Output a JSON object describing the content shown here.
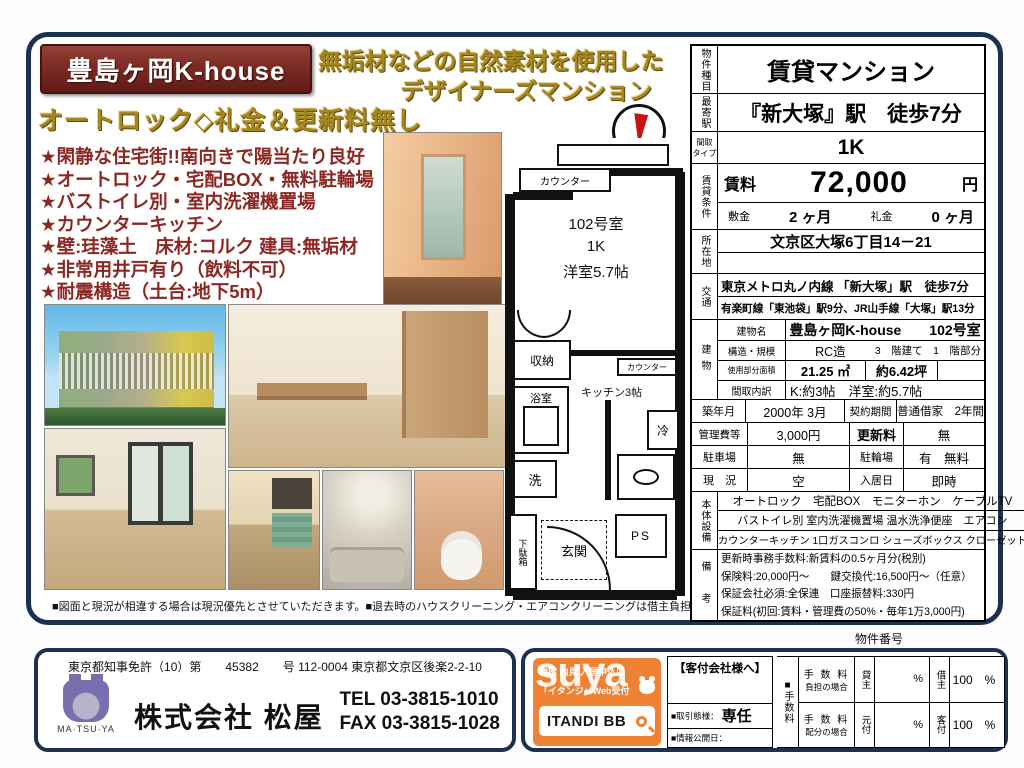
{
  "colors": {
    "maroon": "#7c2a24",
    "gold": "#a6871f",
    "navy": "#1c3150",
    "orange": "#ef8132",
    "feature_red": "#8c2723",
    "logo_purple": "#7a6fae"
  },
  "header": {
    "title": "豊島ヶ岡K-house",
    "subtitle1": "無垢材などの自然素材を使用した",
    "subtitle2": "デザイナーズマンション",
    "tagline": "オートロック◇礼金＆更新料無し"
  },
  "features": [
    "★閑静な住宅街!!南向きで陽当たり良好",
    "★オートロック・宅配BOX・無料駐輪場",
    "★バストイレ別・室内洗濯機置場",
    "★カウンターキッチン",
    "★壁:珪藻土　床材:コルク 建具:無垢材",
    "★非常用井戸有り（飲料不可）",
    "★耐震構造（土台:地下5m）"
  ],
  "plan": {
    "room_no": "102号室",
    "layout": "1K",
    "room_size": "洋室5.7帖",
    "kitchen": "キッチン3帖",
    "counter_top": "カウンター",
    "counter_mid": "カウンター",
    "closet": "収納",
    "bath": "浴室",
    "wash": "洗",
    "fridge": "冷",
    "entrance": "玄関",
    "shoebox": "下駄箱",
    "ps": "PS",
    "north": "N"
  },
  "disclaimer": "■図面と現況が相違する場合は現況優先とさせていただきます。■退去時のハウスクリーニング・エアコンクリーニングは借主負担です。",
  "spec": {
    "type_label": "物件種目",
    "type": "賃貸マンション",
    "station_label": "最寄駅",
    "station": "『新大塚』駅　徒歩7分",
    "madori_label1": "間取",
    "madori_label2": "タイプ",
    "madori": "1K",
    "terms_label": "賃貸条件",
    "rent_label": "賃料",
    "rent": "72,000",
    "rent_unit": "円",
    "deposit_label": "敷金",
    "deposit": "2 ヶ月",
    "keymoney_label": "礼金",
    "keymoney": "0 ヶ月",
    "address_label": "所在地",
    "address": "文京区大塚6丁目14－21",
    "access_label": "交通",
    "access1": "東京メトロ丸ノ内線 「新大塚」駅　徒歩7分",
    "access2": "有楽町線「東池袋」駅9分、JR山手線「大塚」駅13分",
    "bldg_label": "建物",
    "bldg_name_label": "建物名",
    "bldg_name": "豊島ヶ岡K-house　　102号室",
    "structure_label": "構造・規模",
    "structure": "RC造",
    "structure2": "3　階建て　1　階部分",
    "area_label": "使用部分面積",
    "area": "21.25 ㎡",
    "area2": "約6.42坪",
    "madori_detail_label": "間取内訳",
    "madori_detail": "K:約3帖　洋室:約5.7帖",
    "built_label": "築年月",
    "built": "2000年 3月",
    "contract_label": "契約期間",
    "contract": "普通借家　2年間",
    "mgmt_label": "管理費等",
    "mgmt": "3,000円",
    "renewal_label": "更新料",
    "renewal": "無",
    "parking_label": "駐車場",
    "parking": "無",
    "bicycle_label": "駐輪場",
    "bicycle": "有　無料",
    "status_label": "現　況",
    "status": "空",
    "movein_label": "入居日",
    "movein": "即時",
    "equip_label": "本体設備",
    "equip1": "オートロック　宅配BOX　モニターホン　ケーブルTV",
    "equip2": "バストイレ別 室内洗濯機置場 温水洗浄便座　エアコン",
    "equip3": "カウンターキッチン 1口ガスコンロ シューズボックス クローゼット",
    "notes_label": "備　考",
    "notes": [
      "更新時事務手数料:新賃料の0.5ヶ月分(税別)",
      "保険料:20,000円～　　鍵交換代:16,500円～（任意）",
      "保証会社必須:全保連　口座振替料:330円",
      "保証料(初回:賃料・管理費の50%・毎年1万3,000円)"
    ]
  },
  "property_number_label": "物件番号",
  "company": {
    "license": "東京都知事免許（10）第　　45382　　号",
    "address": "112-0004 東京都文京区後楽2-2-10",
    "logo": "MA·TSU·YA",
    "name": "株式会社 松屋",
    "tel_label": "TEL",
    "tel": "03-3815-1010",
    "fax_label": "FAX",
    "fax": "03-3815-1028"
  },
  "itandi": {
    "watermark": "suya",
    "line1": "物確 内見 入居申込は",
    "line2": "「イタンジ」Web受付",
    "brand": "ITANDI BB"
  },
  "agent": {
    "header": "【客付会社様へ】",
    "deal_label": "■取引態様：",
    "deal": "専任",
    "publish_label": "■情報公開日：",
    "fee_mark": "■",
    "fee_label": "手数料",
    "r1a": "手 数 料",
    "r1b": "負担の場合",
    "r1p1": "貸主",
    "r1v1": "%",
    "r1p2": "借主",
    "r1v2": "100　%",
    "r2a": "手 数 料",
    "r2b": "配分の場合",
    "r2p1": "元付",
    "r2v1": "%",
    "r2p2": "客付",
    "r2v2": "100　%"
  }
}
